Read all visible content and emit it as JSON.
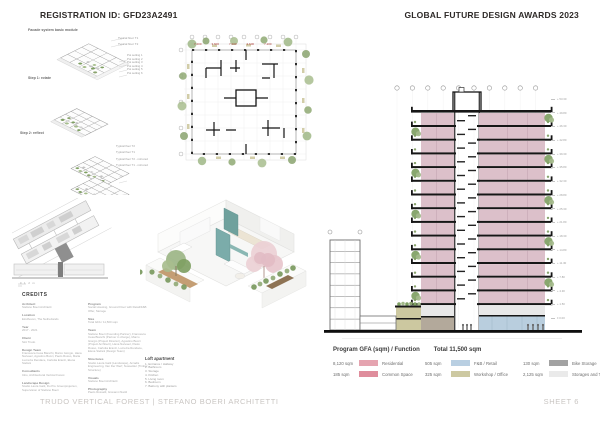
{
  "header": {
    "registration": "REGISTRATION ID: GFD23A2491",
    "award": "GLOBAL FUTURE DESIGN AWARDS 2023"
  },
  "footer": {
    "project": "TRUDO VERTICAL FOREST | STEFANO BOERI ARCHITETTI",
    "sheet": "SHEET 6"
  },
  "facade": {
    "title": "Facade system basic module",
    "step1": "Step 1: rotate",
    "step2": "Step 2: reflect",
    "floor_labels": [
      "Typical floor T1",
      "Typical floor T2"
    ],
    "pot_labels": [
      "Pot setting 1",
      "Pot setting 2",
      "Pot setting 3",
      "Pot setting 4",
      "Pot setting 5",
      "Pot setting 6"
    ],
    "mirror_labels": [
      "Typical floor T2",
      "Typical floor T1",
      "Typical floor T2 - mirrored",
      "Typical floor T1 - mirrored"
    ],
    "scale_note": "0  1  2 m"
  },
  "plan": {
    "dims": [
      "7.200",
      "3.600",
      "7.200",
      "3.600",
      "7.200"
    ]
  },
  "credits": {
    "title": "CREDITS",
    "col1": [
      {
        "h": "Architect",
        "v": "Stefano Boeri Architetti"
      },
      {
        "h": "Location",
        "v": "Eindhoven, The Netherlands"
      },
      {
        "h": "Year",
        "v": "2017 - 2021"
      },
      {
        "h": "Client",
        "v": "Sint Trudo"
      },
      {
        "h": "Design Team",
        "v": "Francesca Cesa Bianchi, Marco Giorgio, Hana Narvaez, Agostino Bucci, Paolo Russo, Maria Lucrezia Rendace, Carlotta Eranzi, Elena Stefani"
      },
      {
        "h": "Consultants",
        "v": "Inbo, Architectural Vertical Forest"
      },
      {
        "h": "Landscape Design",
        "v": "Studio Laura Gatti, Du Pre Groenprojecten, Supervision of Stefano Boeri"
      }
    ],
    "col2": [
      {
        "h": "Program",
        "v": "Social Housing, Ground Floor with Retail/F&B Offer, Storage"
      },
      {
        "h": "Size",
        "v": "Total GFA / 11,500 sqm"
      },
      {
        "h": "Team",
        "v": "Stefano Boeri (Founding Partner), Francesca Cesa Bianchi (Partner in charge), Marco Giorgio (Project Director), Agostino Bucci (Project Architect), Hana Narvaez, Paolo Russo, Carlotta Eranzi, Lucrezia Rendace, Elena Stefani (Design Team)"
      },
      {
        "h": "Structures",
        "v": "Studio Laura Gatti (Landscape), Arcadis Engineering, Van Der Werf, Nusselder (Timber Structure)"
      },
      {
        "h": "Visuals",
        "v": "Stefano Boeri Architetti"
      },
      {
        "h": "Photography",
        "v": "Paolo Rosselli, Giovanni Nardi"
      }
    ]
  },
  "loft": {
    "title": "Loft apartment",
    "items": [
      "1. Entrance / Hallway",
      "2. Bathroom",
      "3. Storage",
      "4. Kitchen",
      "5. Living room",
      "6. Bedroom",
      "7. Balcony with planters"
    ]
  },
  "section": {
    "elevations": [
      "+ 53.30",
      "+ 49.80",
      "+ 46.30",
      "+ 42.80",
      "+ 39.30",
      "+ 35.80",
      "+ 32.30",
      "+ 28.80",
      "+ 25.30",
      "+ 21.80",
      "+ 18.30",
      "+ 14.80",
      "+ 11.30",
      "+ 7.80",
      "+ 4.30",
      "+ 1.50",
      "± 0.00"
    ]
  },
  "program": {
    "title": "Program GFA (sqm) / Function",
    "total": "Total 11,500 sqm",
    "col1": [
      {
        "area": "8,120 sqm",
        "label": "Residential",
        "color": "#e5a4b0"
      },
      {
        "area": "185 sqm",
        "label": "Common Space",
        "color": "#df8d9c"
      }
    ],
    "col2": [
      {
        "area": "505 sqm",
        "label": "F&B / Retail",
        "color": "#b9cfe2"
      },
      {
        "area": "325 sqm",
        "label": "Workshop / Office",
        "color": "#cdc9a2"
      }
    ],
    "col3": [
      {
        "area": "130 sqm",
        "label": "Bike Storage",
        "color": "#a2a2a2"
      },
      {
        "area": "2,125 sqm",
        "label": "Storages and Technical",
        "color": "#eaeaea"
      }
    ]
  }
}
